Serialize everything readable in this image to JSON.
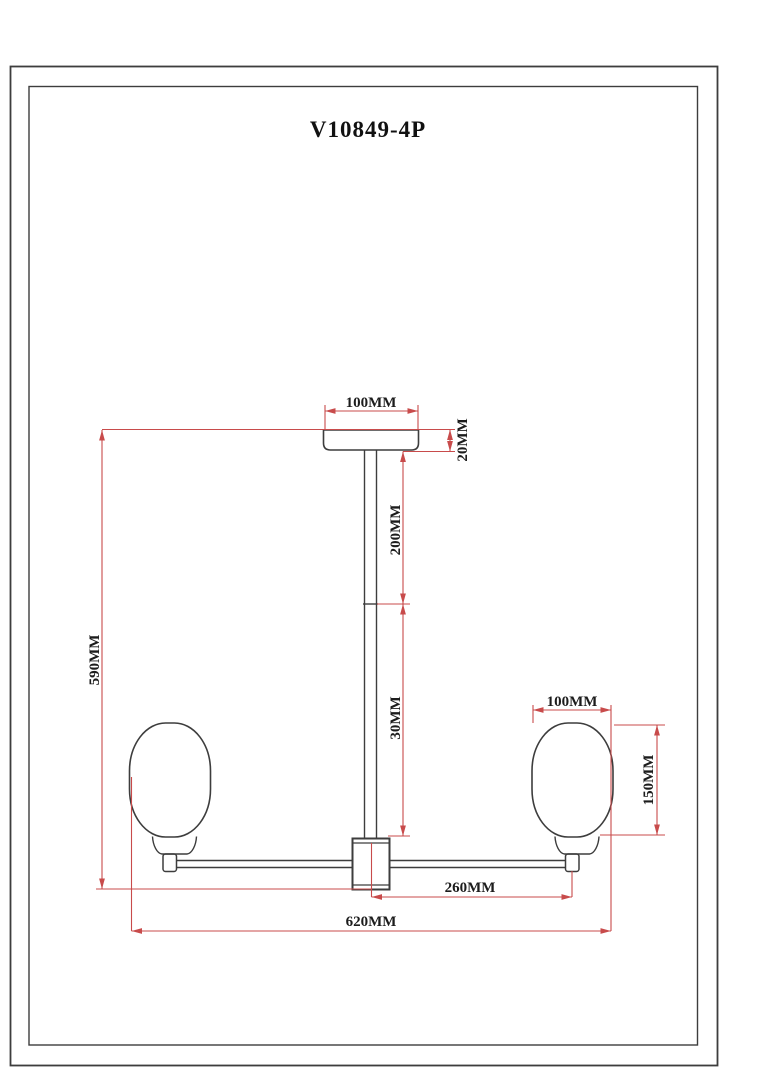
{
  "drawing": {
    "title": "V10849-4P",
    "dimensions": {
      "canopy_width": "100MM",
      "canopy_height": "20MM",
      "upper_rod_length": "200MM",
      "lower_rod_length": "30MM",
      "overall_height": "590MM",
      "shade_width": "100MM",
      "shade_height": "150MM",
      "arm_half_span": "260MM",
      "overall_width": "620MM"
    },
    "colors": {
      "outline": "#3d3d3d",
      "dimension_line": "#c84b4b",
      "text": "#1c1c1c",
      "background": "#ffffff"
    }
  }
}
